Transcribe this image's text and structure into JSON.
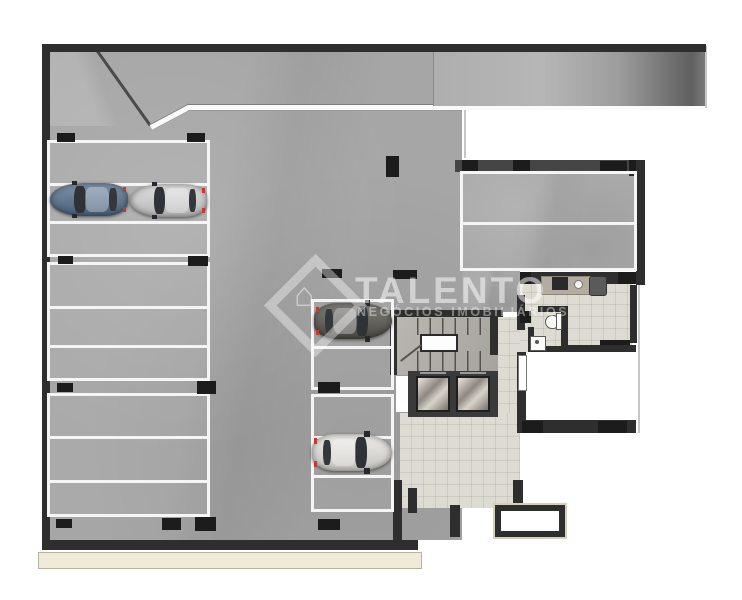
{
  "watermark": {
    "brand": "TALENTO",
    "tagline": "NEGÓCIOS IMOBILIÁRIOS",
    "logo_icon": "⌂",
    "logo_name": "diamond-house-icon"
  },
  "colors": {
    "wall": "#2e2e2e",
    "structural_column": "#1c1c1c",
    "garage_floor": "#a6a6a6",
    "stall_line": "#f5f5f5",
    "lobby_tile": "#dedbd2",
    "sidewalk": "#f0ead9",
    "watermark": "rgba(255,255,255,0.5)"
  },
  "summary": {
    "left_column_stall_groups": 3,
    "left_column_stalls": 9,
    "center_column_stalls": 5,
    "upper_right_room_stalls": 2,
    "cars_parked": 4,
    "elevators": 2
  },
  "plan": {
    "stall_groups": [
      {
        "id": "left-1",
        "x": 47,
        "y": 140,
        "w": 163,
        "h": 117,
        "dividers": [
          40,
          78
        ]
      },
      {
        "id": "left-2",
        "x": 47,
        "y": 262,
        "w": 163,
        "h": 119,
        "dividers": [
          41,
          80
        ]
      },
      {
        "id": "left-3",
        "x": 47,
        "y": 393,
        "w": 163,
        "h": 124,
        "dividers": [
          40,
          84
        ]
      },
      {
        "id": "center-1",
        "x": 311,
        "y": 299,
        "w": 83,
        "h": 91,
        "dividers": [
          44
        ]
      },
      {
        "id": "center-2",
        "x": 311,
        "y": 394,
        "w": 83,
        "h": 118,
        "dividers": [
          39,
          78
        ]
      },
      {
        "id": "right-1",
        "x": 460,
        "y": 171,
        "w": 177,
        "h": 100,
        "dividers": [
          48
        ]
      }
    ],
    "columns": [
      [
        57,
        133,
        18,
        9
      ],
      [
        187,
        133,
        18,
        9
      ],
      [
        58,
        256,
        15,
        8
      ],
      [
        188,
        256,
        20,
        10
      ],
      [
        57,
        383,
        16,
        9
      ],
      [
        197,
        381,
        19,
        13
      ],
      [
        56,
        519,
        16,
        9
      ],
      [
        162,
        518,
        19,
        12
      ],
      [
        195,
        517,
        21,
        14
      ],
      [
        318,
        382,
        22,
        11
      ],
      [
        318,
        519,
        22,
        11
      ],
      [
        322,
        269,
        20,
        9
      ],
      [
        393,
        270,
        24,
        9
      ],
      [
        386,
        156,
        13,
        21
      ]
    ],
    "cars": [
      {
        "id": "blue-suv",
        "x": 50,
        "y": 183,
        "w": 78,
        "h": 33,
        "color": "#54708e",
        "facing": "left"
      },
      {
        "id": "silver-car",
        "x": 130,
        "y": 184,
        "w": 77,
        "h": 33,
        "color": "#d6d6d6",
        "facing": "left"
      },
      {
        "id": "dark-car",
        "x": 314,
        "y": 303,
        "w": 78,
        "h": 36,
        "color": "#57554f",
        "facing": "right"
      },
      {
        "id": "white-car",
        "x": 312,
        "y": 434,
        "w": 80,
        "h": 37,
        "color": "#e9e7e2",
        "facing": "right"
      }
    ]
  }
}
